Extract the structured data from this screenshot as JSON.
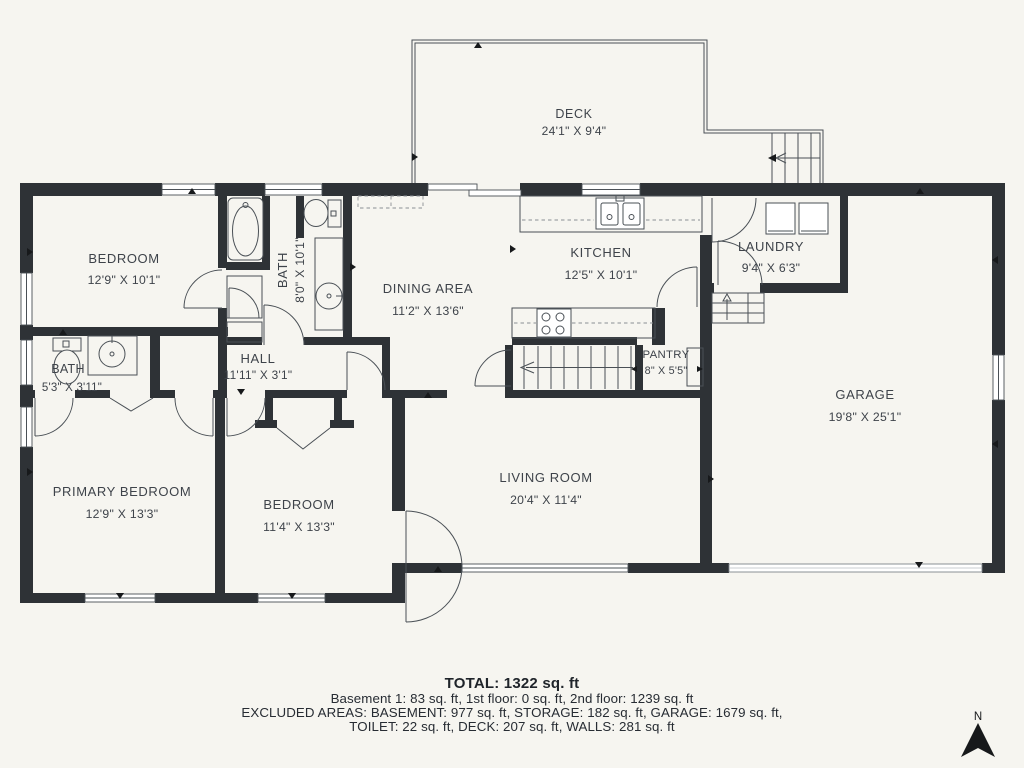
{
  "rooms": [
    {
      "name": "DECK",
      "dims": "24'1\" X 9'4\""
    },
    {
      "name": "BEDROOM",
      "dims": "12'9\" X 10'1\""
    },
    {
      "name": "BATH",
      "dims": "8'0\" X 10'1\""
    },
    {
      "name": "DINING AREA",
      "dims": "11'2\" X 13'6\""
    },
    {
      "name": "KITCHEN",
      "dims": "12'5\" X 10'1\""
    },
    {
      "name": "LAUNDRY",
      "dims": "9'4\" X 6'3\""
    },
    {
      "name": "HALL",
      "dims": "11'11\" X 3'1\""
    },
    {
      "name": "BATH",
      "dims": "5'3\" X 3'11\""
    },
    {
      "name": "PANTRY",
      "dims": "8\" X 5'5\""
    },
    {
      "name": "GARAGE",
      "dims": "19'8\" X 25'1\""
    },
    {
      "name": "PRIMARY BEDROOM",
      "dims": "12'9\" X 13'3\""
    },
    {
      "name": "BEDROOM",
      "dims": "11'4\" X 13'3\""
    },
    {
      "name": "LIVING ROOM",
      "dims": "20'4\" X 11'4\""
    }
  ],
  "summary": {
    "total": "TOTAL: 1322 sq. ft",
    "line1": "Basement 1: 83 sq. ft, 1st floor: 0 sq. ft, 2nd floor: 1239 sq. ft",
    "line2": "EXCLUDED AREAS: BASEMENT: 977 sq. ft, STORAGE: 182 sq. ft, GARAGE: 1679 sq. ft,",
    "line3": "TOILET: 22 sq. ft, DECK: 207 sq. ft, WALLS: 281 sq. ft"
  },
  "compass": {
    "label": "N"
  },
  "colors": {
    "background": "#f6f5f0",
    "wall": "#2e3236",
    "line": "#4a5056",
    "text": "#3e434a",
    "summary_text": "#1f242a"
  }
}
